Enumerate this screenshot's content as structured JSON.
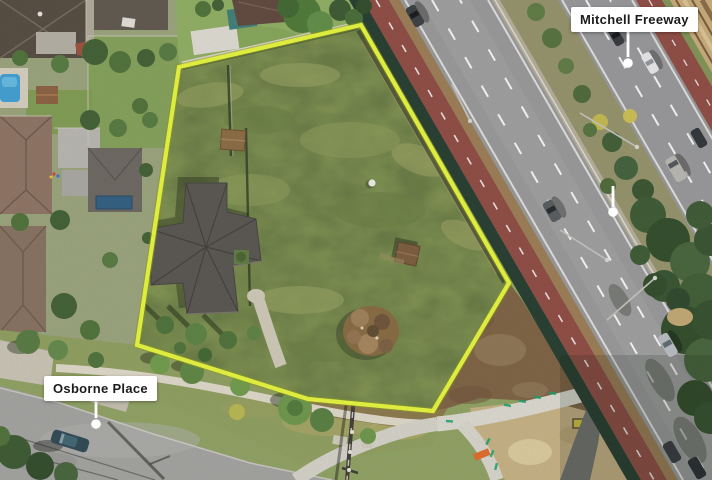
{
  "labels": {
    "freeway": "Mitchell Freeway",
    "street": "Osborne Place"
  },
  "colors": {
    "property_boundary": "#e7f63c",
    "boundary_shadow": "#8a9a1e",
    "label_background": "#ffffff",
    "label_text": "#1c1c1c",
    "leader_line": "#ffffff",
    "leader_dot": "#ffffff",
    "lot_grass": "#7e914f",
    "freeway_asphalt": "#98989a",
    "bike_path_red": "#8e4a42",
    "median_trees": "#3c5a33",
    "dirt_brown": "#7d6142",
    "sand_tan": "#c6b183",
    "path_concrete": "#dcdad2",
    "street_asphalt": "#a2a2a0"
  }
}
